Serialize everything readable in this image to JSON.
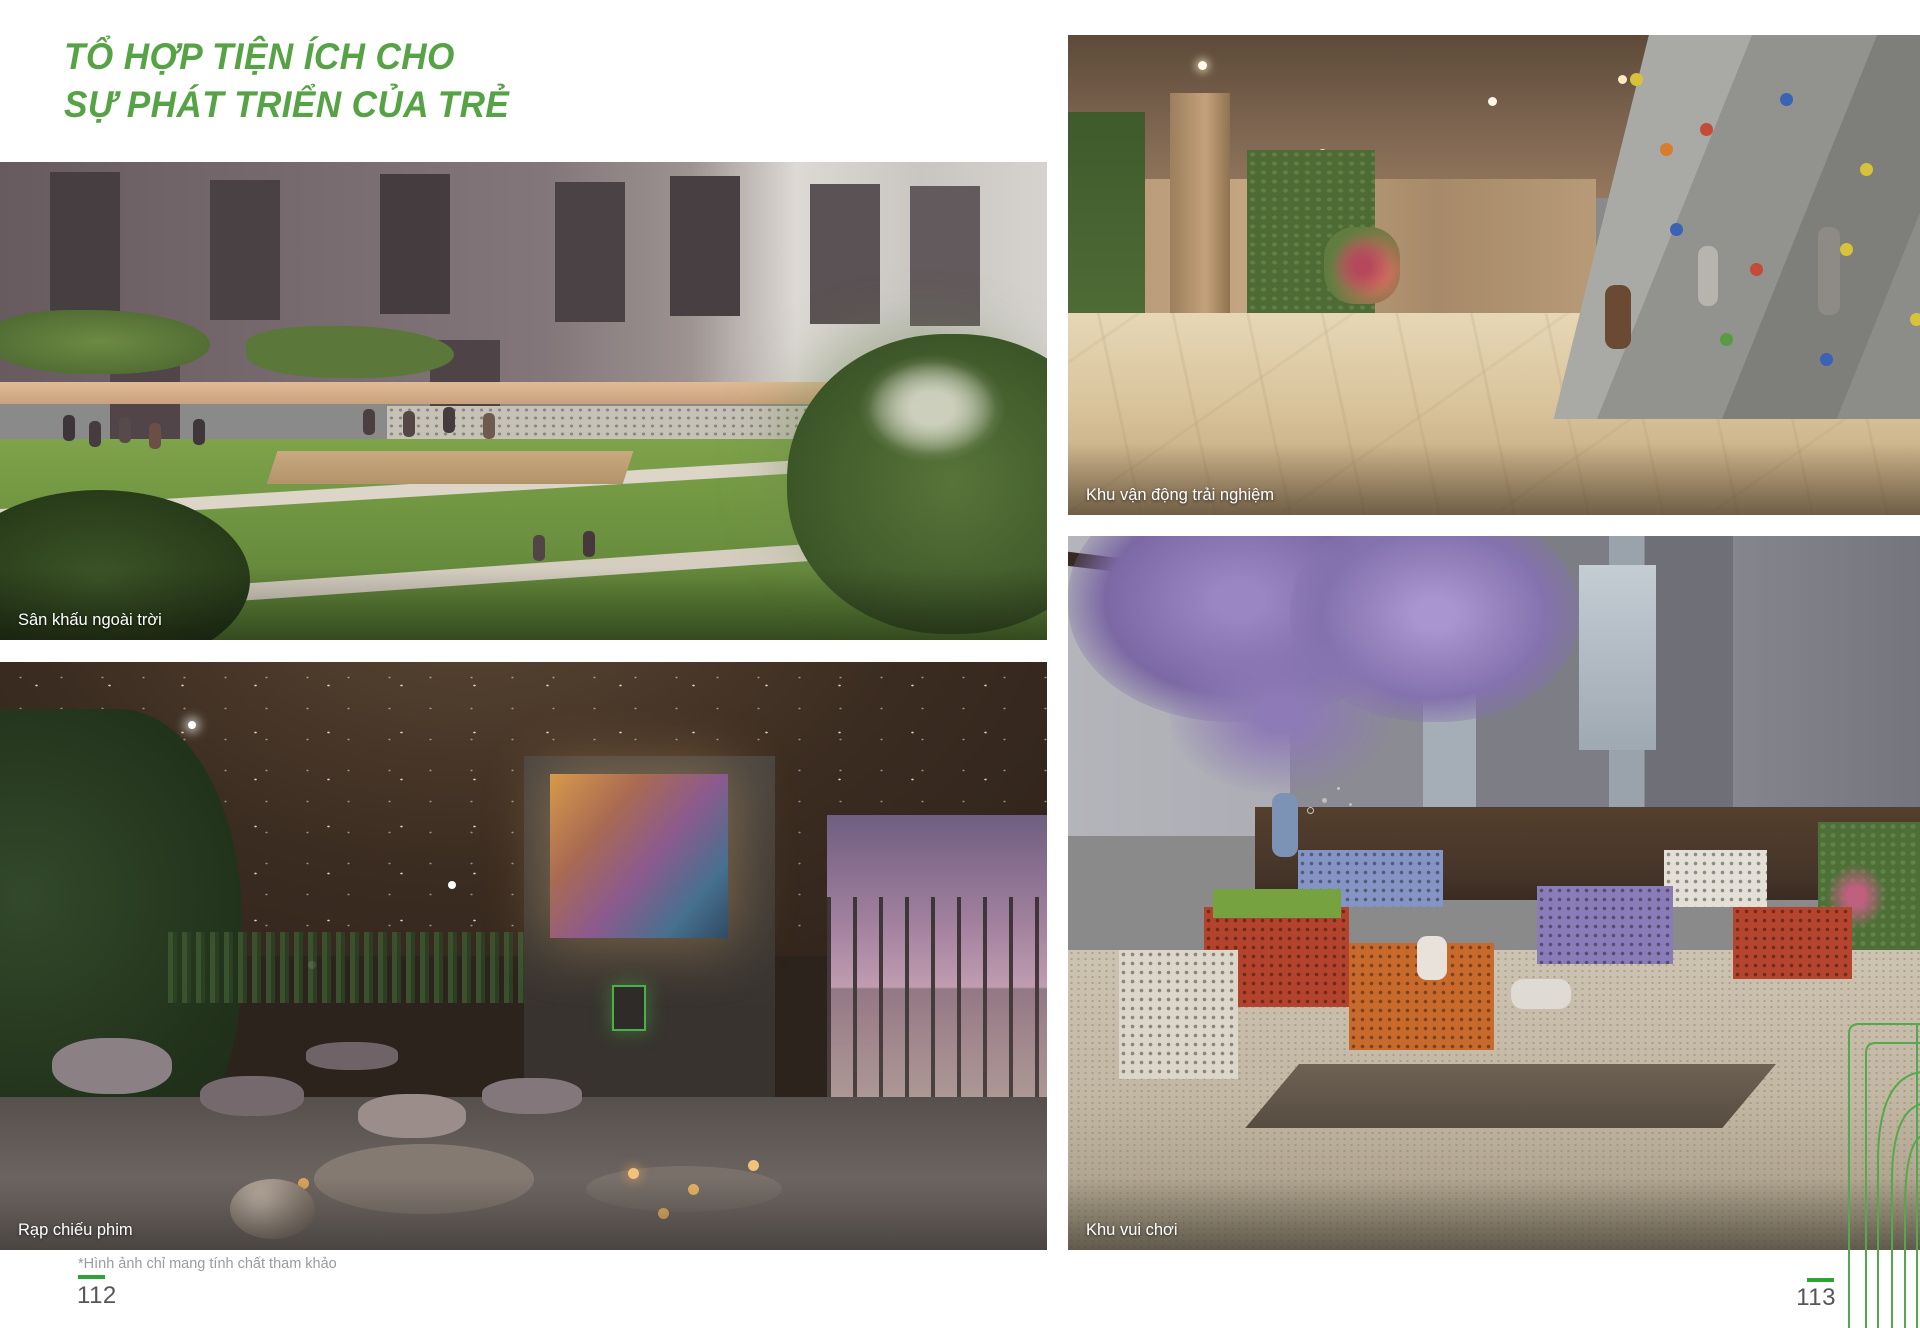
{
  "colors": {
    "title_green": "#56A346",
    "accent_green": "#2FA336",
    "lineart_green": "#54A94C",
    "page_number_gray": "#54565A",
    "footnote_gray": "#9B9B9B",
    "caption_white": "#FFFFFF"
  },
  "header": {
    "title_line1": "TỔ HỢP TIỆN ÍCH CHO",
    "title_line2": "SỰ PHÁT TRIỂN CỦA TRẺ"
  },
  "photos": [
    {
      "caption": "Sân khấu ngoài trời"
    },
    {
      "caption": "Khu vận động trải nghiệm"
    },
    {
      "caption": "Rạp chiếu phim"
    },
    {
      "caption": "Khu vui chơi"
    }
  ],
  "footer": {
    "footnote": "*Hình ảnh chỉ mang tính chất tham khảo",
    "page_left": "112",
    "page_right": "113"
  }
}
